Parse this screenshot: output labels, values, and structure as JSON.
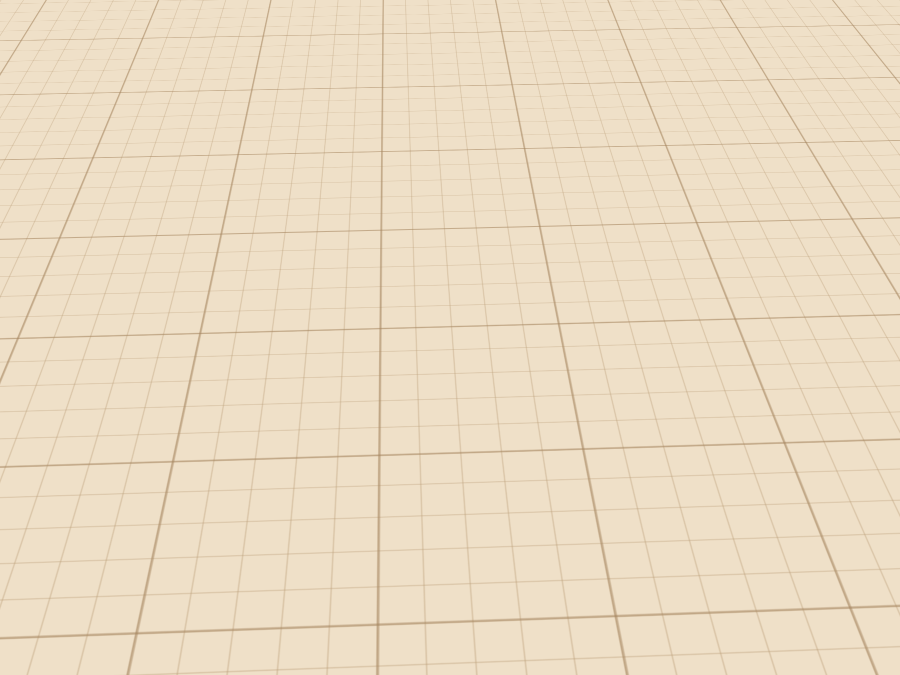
{
  "watermark": {
    "text": "planner",
    "logo": "5d"
  },
  "colors": {
    "background": "#efe0c8",
    "grid_line": "#d3bfa4",
    "wall_top": "#eef0f2",
    "wallpaper": "#dcd0ca",
    "floor_green": "#6d7f62",
    "maroon_dark": "#560e12",
    "maroon": "#6e1216",
    "maroon_light": "#8f1d22",
    "rug_red": "#c23b28",
    "curtain": "#8a3a33",
    "sheer_cream": "#d9d3ba",
    "counter_tan": "#b3906c",
    "exterior_gray": "#c9cdd1",
    "mosaic_gray": "#a6a29d",
    "door_cream": "#eae3d3",
    "glass_teal": "#9fc6c6",
    "bed_white": "#ededed",
    "bed_blue_band": "#cfe0ec",
    "lamp_cream": "#e6dfc5",
    "watermark_tan": "#b5894f"
  },
  "scene": {
    "type": "3d-floorplan-render",
    "view": "elevated front perspective, plan rotated slightly",
    "rooms": [
      {
        "id": "living-room",
        "floor": "green damask tile",
        "objects": [
          "french-window",
          "maroon-curtains",
          "sheer-curtains",
          "curtain-rod",
          "wall-painting",
          "sunset-wall-art",
          "tv-screen",
          "tv-stand",
          "sage-sideboard",
          "pendant-lamps x5",
          "red-area-rug",
          "red-sofa",
          "coffee-table",
          "potted-plant",
          "ring-shelf",
          "tufted-armchair",
          "pleated-panel",
          "partition-tv"
        ]
      },
      {
        "id": "kitchen",
        "objects": [
          "corner-cabinets",
          "cone-extractor-hood",
          "l-shaped-bar-counter",
          "cooktop",
          "oven",
          "fruit-bowl",
          "plates",
          "bottle",
          "serving-tray",
          "bar-stools x2",
          "kettle",
          "refrigerator"
        ]
      },
      {
        "id": "bedroom",
        "objects": [
          "double-bed",
          "pillows x2",
          "floral-bed-runner",
          "arc-floor-lamp",
          "nightstand",
          "ladder-shelf",
          "corner-wardrobe",
          "large-wardrobe"
        ]
      },
      {
        "id": "bathroom",
        "floor": "gray mosaic",
        "objects": [
          "round-shower-cabin",
          "side-table",
          "red-door-with-mirror",
          "bath-mat",
          "glass-sliding-door"
        ]
      }
    ],
    "facade": [
      "maroon-wall-panel",
      "cream-entry-door-teal-glass",
      "teal-window"
    ]
  }
}
